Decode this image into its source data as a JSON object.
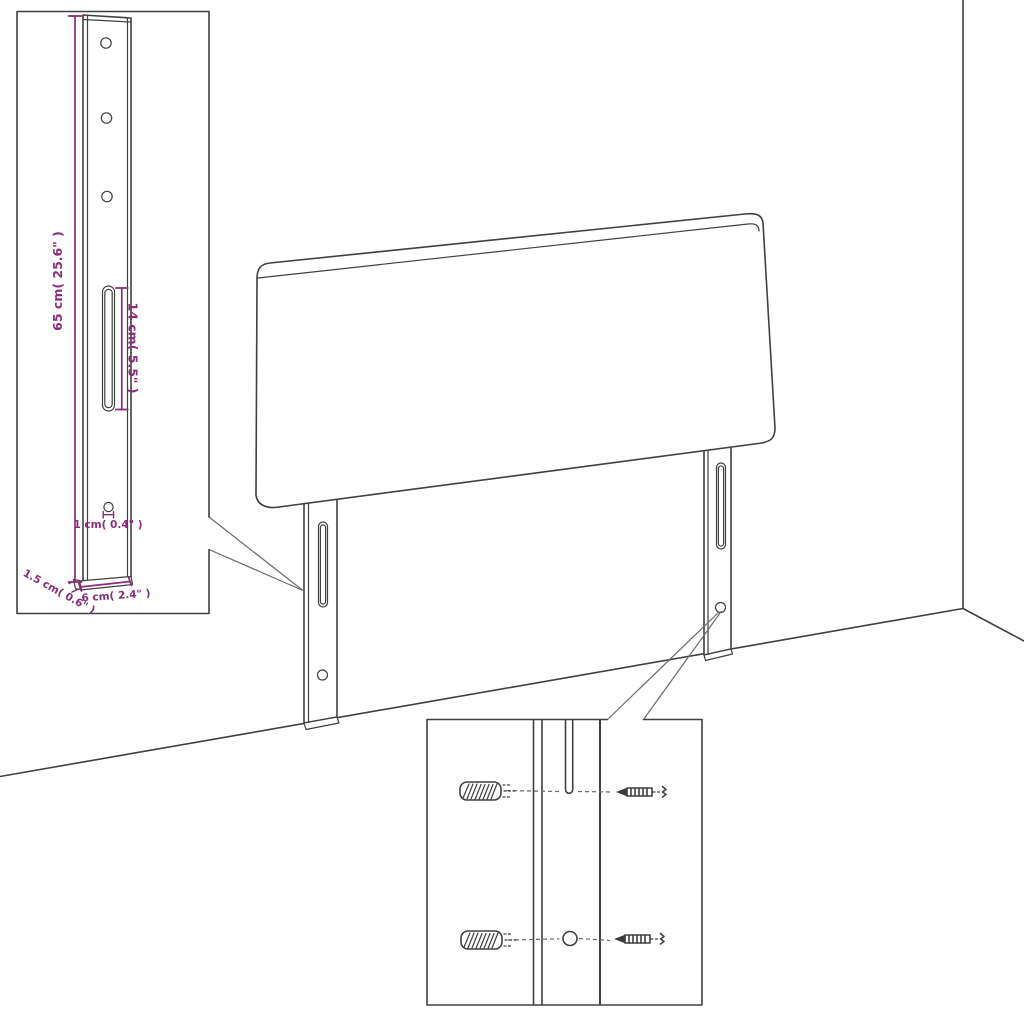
{
  "colors": {
    "dimension_accent": "#8B2C7C",
    "line": "#404040",
    "background": "#FFFFFF"
  },
  "annotations": {
    "height": "65 cm( 25.6\" )",
    "slot": "14 cm( 5.5\" )",
    "hole": "1 cm( 0.4\" )",
    "thickness": "1.5 cm( 0.6\" )",
    "width": "6 cm( 2.4\" )"
  }
}
